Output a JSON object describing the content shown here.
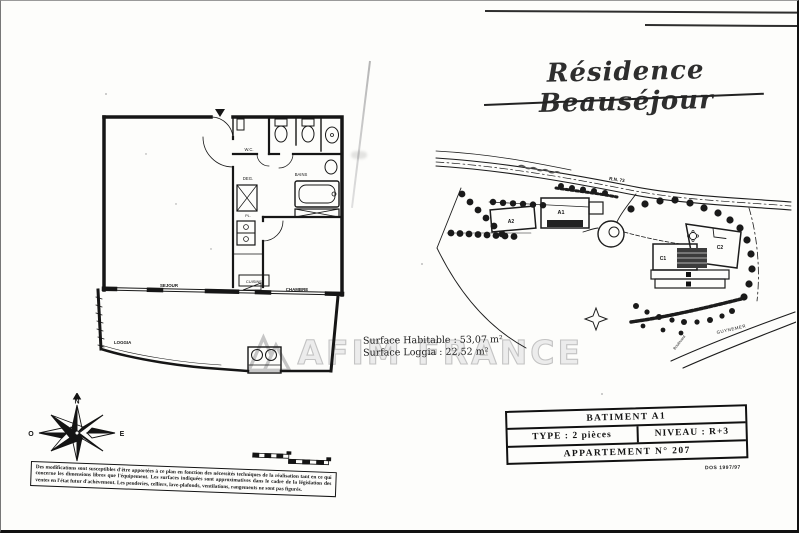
{
  "title": "Résidence Beauséjour",
  "floor_plan": {
    "rooms": {
      "sejour": "SEJOUR",
      "cuisine": "CUISINE",
      "chambre": "CHAMBRE",
      "loggia": "LOGGIA",
      "wc": "W.C.",
      "bains": "BAINS",
      "deg": "DEG.",
      "pl": "PL."
    }
  },
  "surfaces": {
    "habitable": "Surface Habitable : 53,07 m²",
    "loggia": "Surface Loggia : 22,52 m²"
  },
  "watermark": {
    "text": "AFIM FRANCE"
  },
  "site_plan": {
    "buildings": {
      "a1": "A1",
      "a2": "A2",
      "c1": "C1",
      "c2": "C2"
    },
    "roads": {
      "rn": "R.N. 73",
      "guynemer": "GUYNEMER",
      "boulevard": "Boulevard"
    }
  },
  "compass": {
    "n": "N",
    "s": "S",
    "e": "E",
    "o": "O"
  },
  "info_table": {
    "batiment": "BATIMENT A1",
    "type": "TYPE : 2 pièces",
    "niveau": "NIVEAU : R+3",
    "appartement": "APPARTEMENT N° 207",
    "ref": "DOS 1997/97"
  },
  "disclaimer": "Des modifications sont susceptibles d'être apportées à ce plan en fonction des nécessités techniques de la réalisation tant en ce qui concerne les dimensions libres que l'équipement. Les surfaces indiquées sont approximatives dans le cadre de la législation des ventes en l'état futur d'achèvement. Les penderies, celliers, lave-plafonds, ventilations, rangements ne sont pas figurés."
}
